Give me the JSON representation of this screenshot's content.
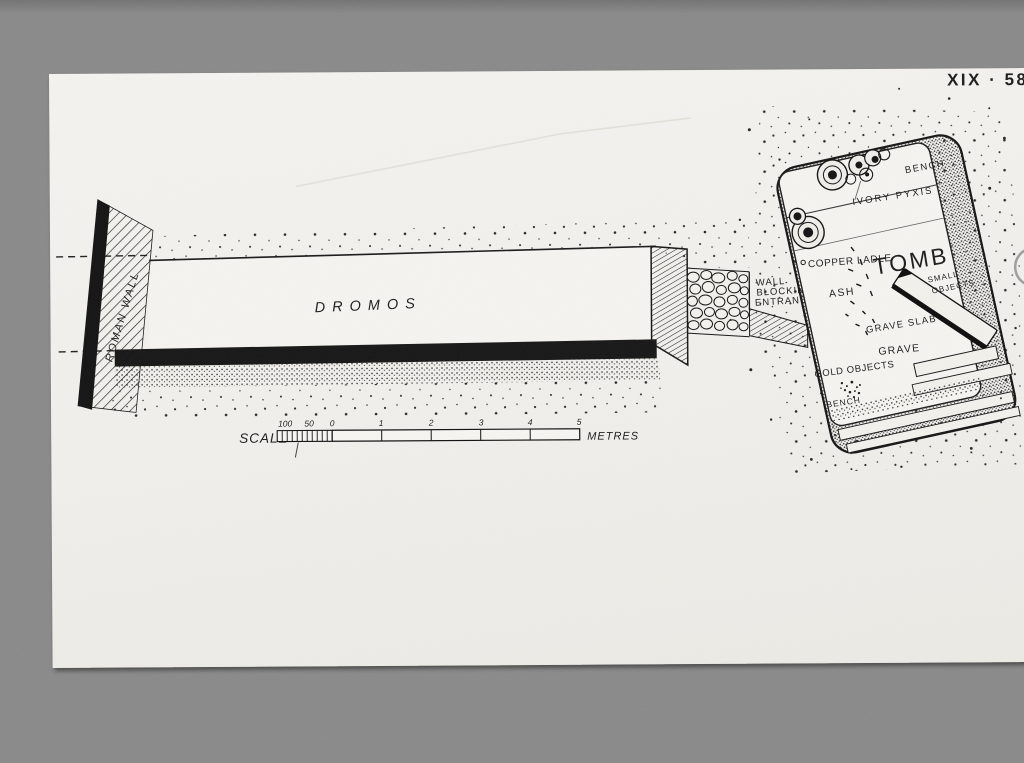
{
  "colors": {
    "background": "#8a8a8a",
    "paper": "#f1f0eb",
    "ink": "#1a1a1a"
  },
  "plate": {
    "number": "XIX · 58"
  },
  "plan": {
    "roman_wall": "ROMAN WALL",
    "dromos": "DROMOS",
    "blocking": {
      "line1": "WALL",
      "line2": "BLOCKING",
      "line3": "ENTRANCE"
    },
    "tomb": {
      "title": "TOMB",
      "bench_top": "BENCH",
      "ivory_pyxis": "IVORY PYXIS",
      "copper_ladle": "COPPER LADLE",
      "small_objects_1": "SMALL",
      "small_objects_2": "OBJECTS",
      "ash": "ASH",
      "grave_slab": "GRAVE SLAB",
      "grave": "GRAVE",
      "gold_objects": "GOLD OBJECTS",
      "bench_bottom": "BENCH"
    },
    "scale": {
      "label": "SCALE",
      "units": "METRES",
      "ticks": [
        "100",
        "50",
        "0",
        "1",
        "2",
        "3",
        "4",
        "5"
      ]
    }
  }
}
